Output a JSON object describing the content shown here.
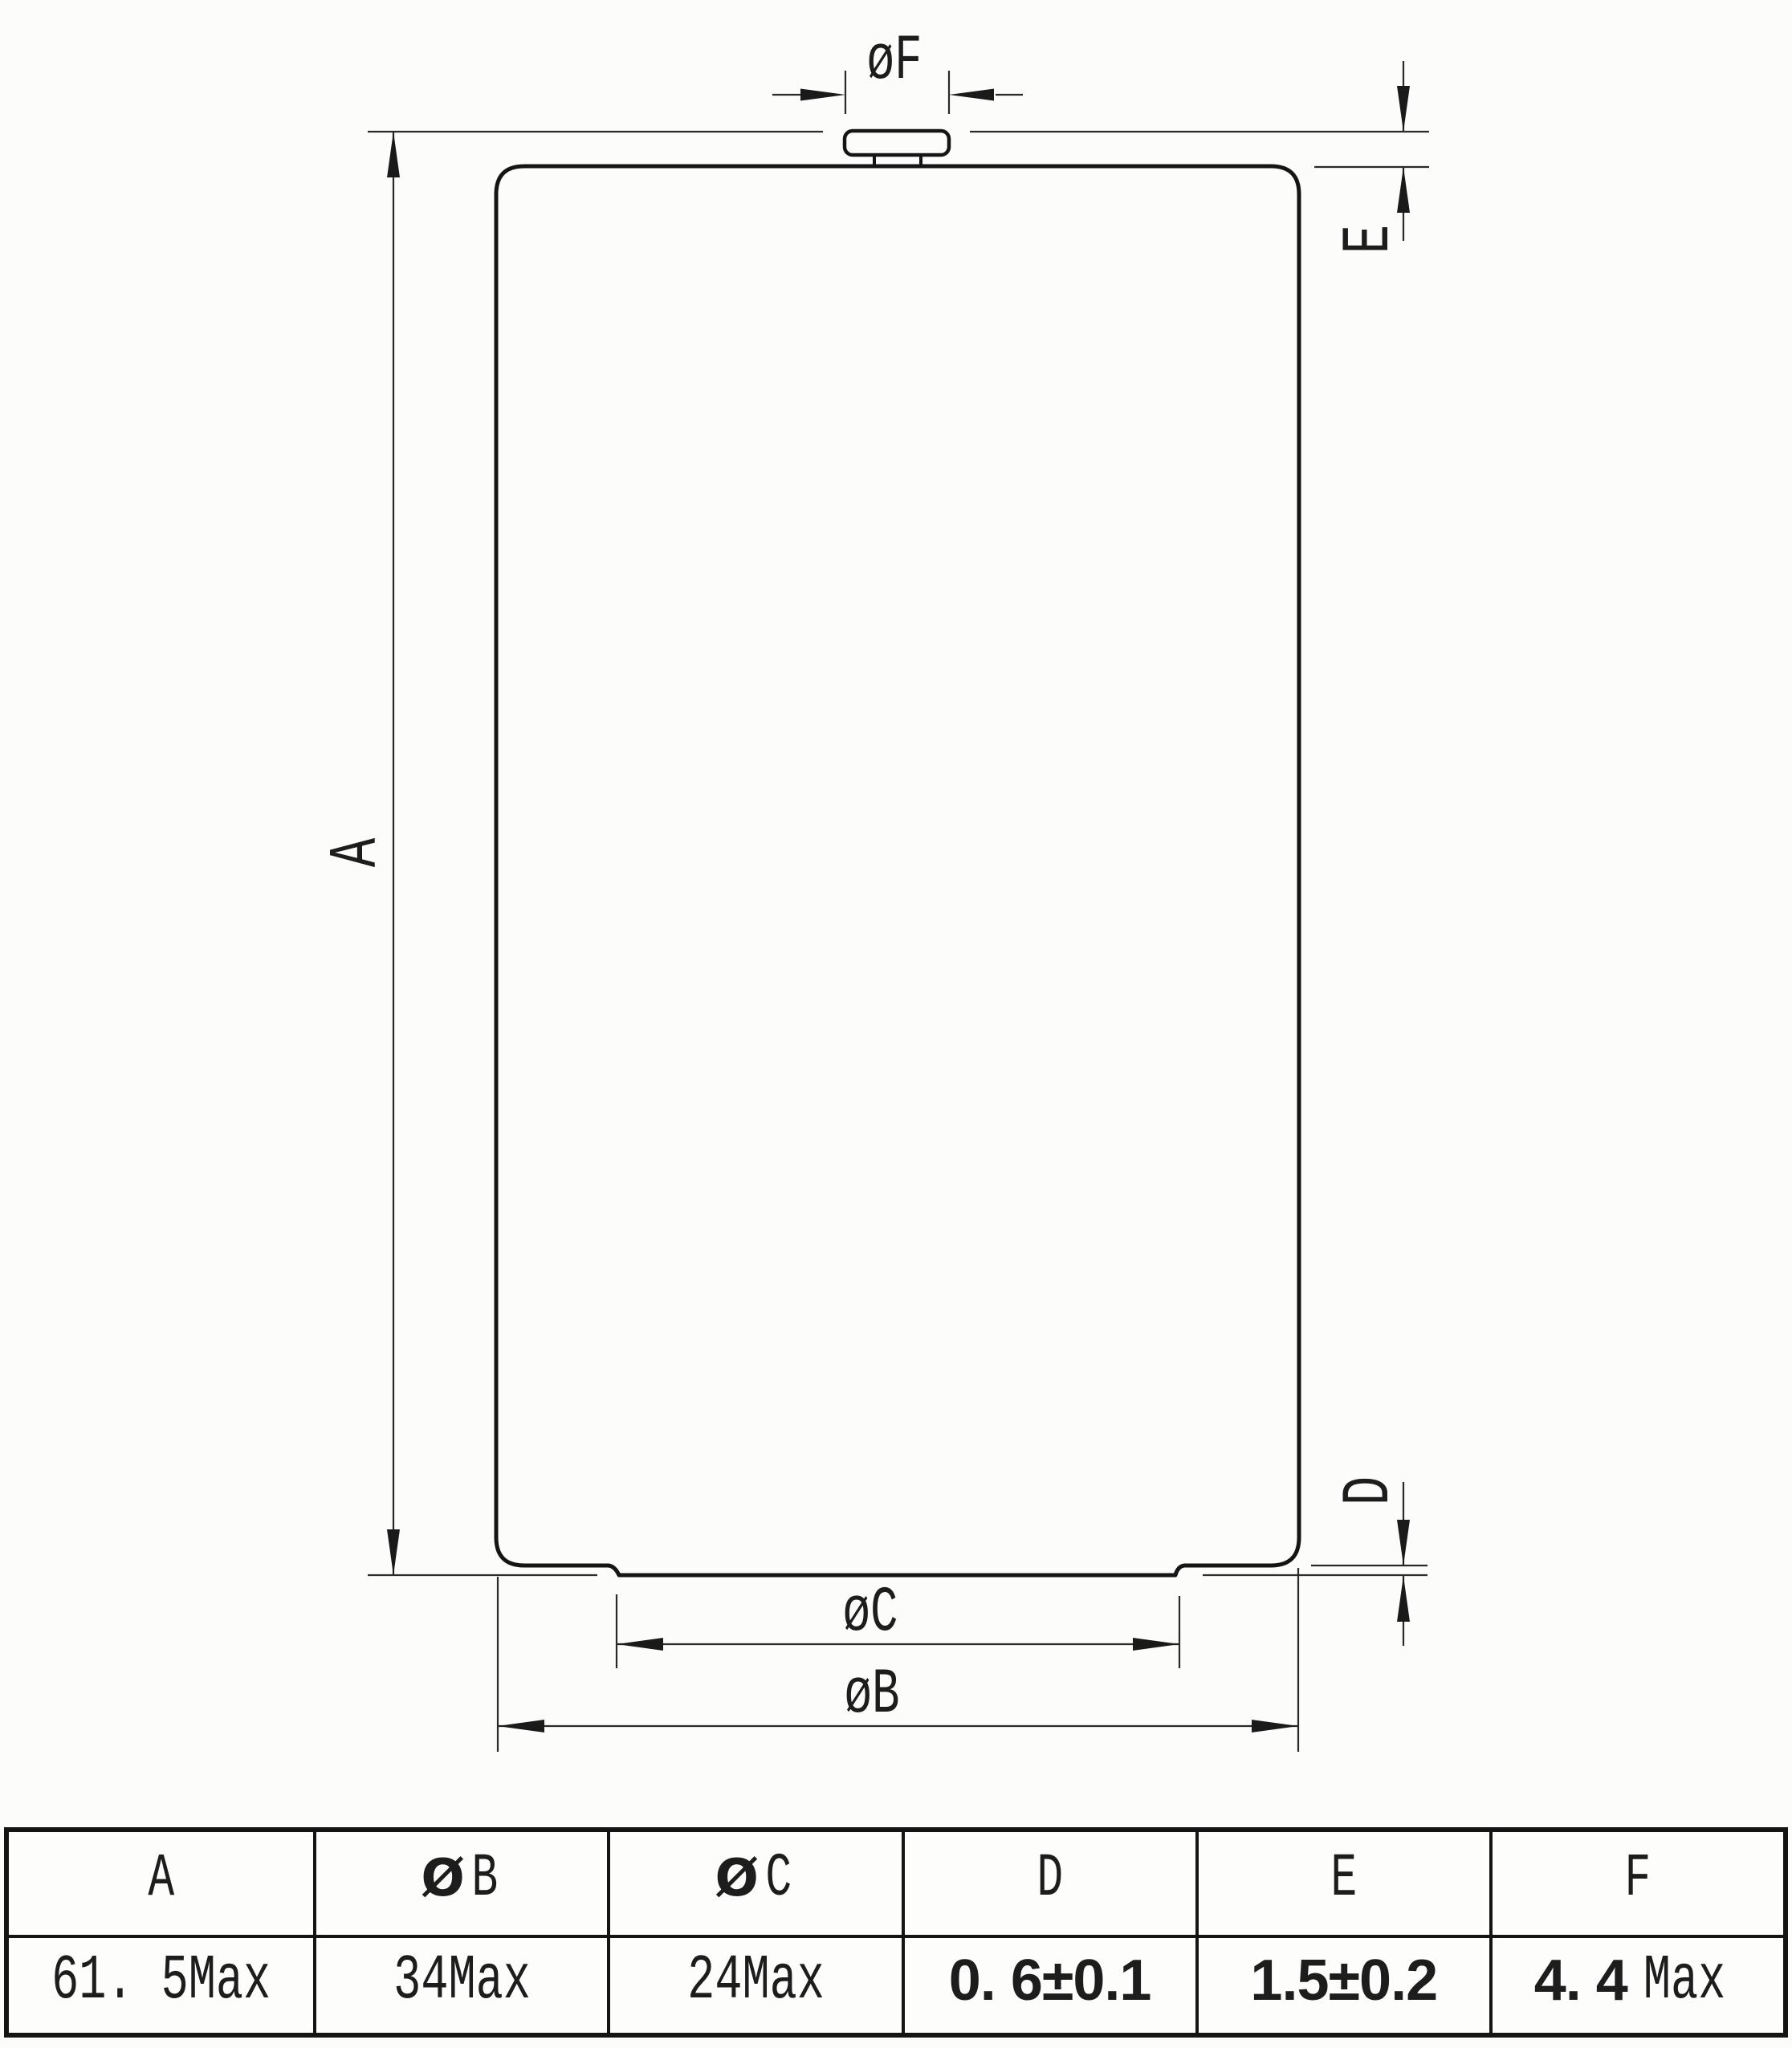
{
  "drawing": {
    "labels": {
      "overall_height": "A",
      "tip_diameter": "øF",
      "tip_height": "E",
      "base_step_height": "D",
      "base_flat_diameter": "øC",
      "body_diameter": "øB"
    }
  },
  "spec_table": {
    "columns": [
      {
        "header": "A",
        "value": "61. 5Max"
      },
      {
        "header_symbol": "Ø",
        "header": "B",
        "value": "34Max"
      },
      {
        "header_symbol": "Ø",
        "header": "C",
        "value": "24Max"
      },
      {
        "header": "D",
        "value": "0. 6±0.1"
      },
      {
        "header": "E",
        "value": "1.5±0.2"
      },
      {
        "header": "F",
        "value_number": "4. 4",
        "value_unit": "Max"
      }
    ]
  }
}
